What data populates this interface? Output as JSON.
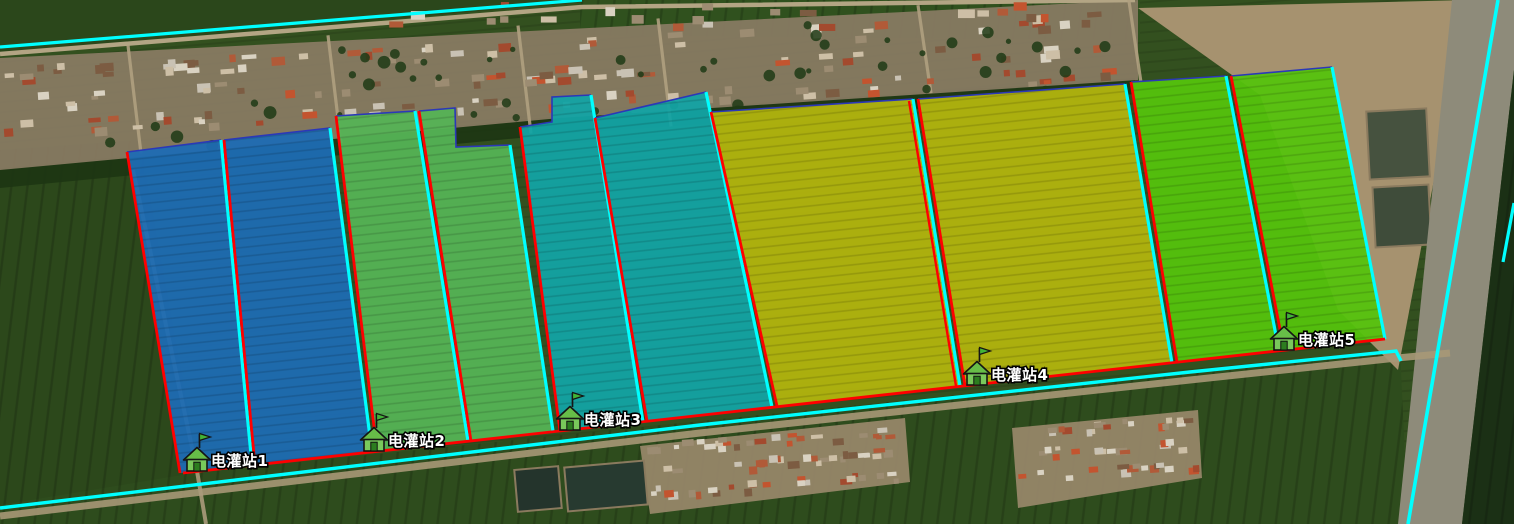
{
  "map": {
    "description": "Satellite map of irrigation district with colored parcel overlays and electric pump station markers",
    "colors": {
      "boundary_red": "#ff0000",
      "boundary_cyan": "#00ffff",
      "outline_navy": "#2b38b8",
      "label_text": "#ffffff",
      "label_outline": "#000000",
      "marker_green": "#79c95b",
      "zone_blue": "#1d6bb3",
      "zone_green": "#55b355",
      "zone_teal": "#13a3a4",
      "zone_olive": "#b2b40e",
      "zone_bright_green": "#55c30d"
    },
    "zones": [
      {
        "id": "zone-1-blue",
        "color": "#1d6bb3",
        "parcels": [
          {
            "points": "127,152 221,140 252,465 180,473",
            "navy": "127,152 221,140",
            "red": "127,152 180,473",
            "cyan": "221,140 252,465"
          },
          {
            "points": "224,140 330,128 372,452 255,465",
            "navy": "224,140 330,128",
            "red": "224,140 255,465",
            "cyan": "330,128 372,452"
          }
        ]
      },
      {
        "id": "zone-2-green",
        "color": "#55b355",
        "parcels": [
          {
            "points": "336,116 415,111 468,441 377,451",
            "navy": "336,116 415,111",
            "red": "336,116 377,451",
            "cyan": "415,111 468,441"
          },
          {
            "points": "419,111 455,108 456,147 510,145 553,431 471,441",
            "navy": "419,111 455,108 456,147 510,145",
            "red": "419,111 471,441",
            "cyan": "510,145 553,431"
          }
        ]
      },
      {
        "id": "zone-3-teal",
        "color": "#13a3a4",
        "parcels": [
          {
            "points": "520,127 552,122 552,97 591,95 643,422 560,431",
            "navy": "520,127 552,122 552,97 591,95",
            "red": "520,127 560,431",
            "cyan": "591,95 643,422"
          },
          {
            "points": "595,118 706,92 772,407 647,421",
            "navy": "595,118 706,92",
            "red": "595,118 647,421",
            "cyan": "706,92 772,407"
          }
        ]
      },
      {
        "id": "zone-4-olive",
        "color": "#b2b40e",
        "parcels": [
          {
            "points": "711,112 913,99 960,386 777,406",
            "navy": "711,112 913,99",
            "red": "711,112 777,406",
            "cyan": "913,99 960,386"
          },
          {
            "points": "918,99 1125,84 1172,363 965,386",
            "navy": "918,99 1125,84",
            "red": "918,99 965,386",
            "cyan": "1125,84 1172,363"
          }
        ]
      },
      {
        "id": "zone-5-bright-green",
        "color": "#55c30d",
        "parcels": [
          {
            "points": "1131,82 1226,76 1279,351 1177,362",
            "navy": "1131,82 1226,76",
            "red": "1131,82 1177,362",
            "cyan": "1226,76 1279,351"
          },
          {
            "points": "1231,76 1332,67 1385,339 1284,350",
            "navy": "1231,76 1332,67",
            "red": "1231,76 1284,350",
            "cyan": "1332,67 1385,339"
          }
        ]
      }
    ],
    "lines": [
      {
        "name": "top-road-cyan-line",
        "color": "cyan",
        "width": 3.2,
        "points": "0,47 582,0"
      },
      {
        "name": "bottom-canal-cyan-line",
        "color": "cyan",
        "width": 3.4,
        "points": "0,508 700,425 1190,372 1396,351 1401,361"
      },
      {
        "name": "bottom-boundary-red-line",
        "color": "red",
        "width": 2.8,
        "points": "183,473 1385,339"
      },
      {
        "name": "right-road-cyan-line",
        "color": "cyan",
        "width": 3.6,
        "points": "1498,0 1408,524"
      },
      {
        "name": "right-road-cyan-short-line",
        "color": "cyan",
        "width": 3.2,
        "points": "1514,203 1503,262"
      },
      {
        "name": "olive-division-red-line",
        "color": "red",
        "width": 2.4,
        "points": "909,101 956,386"
      }
    ],
    "stations": [
      {
        "id": "station-1",
        "label": "电灌站1",
        "x": 197,
        "y": 471,
        "transform": "translate(197,471)"
      },
      {
        "id": "station-2",
        "label": "电灌站2",
        "x": 374,
        "y": 451,
        "transform": "translate(374,451)"
      },
      {
        "id": "station-3",
        "label": "电灌站3",
        "x": 570,
        "y": 430,
        "transform": "translate(570,430)"
      },
      {
        "id": "station-4",
        "label": "电灌站4",
        "x": 977,
        "y": 385,
        "transform": "translate(977,385)"
      },
      {
        "id": "station-5",
        "label": "电灌站5",
        "x": 1284,
        "y": 350,
        "transform": "translate(1284,350)"
      }
    ]
  }
}
